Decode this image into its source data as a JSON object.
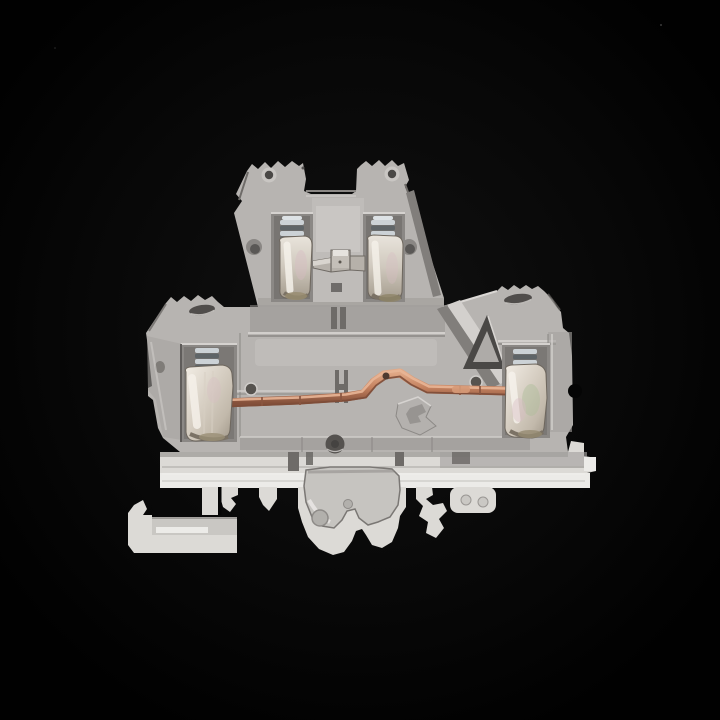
{
  "scene": {
    "type": "product-photograph",
    "description": "Gray double-level DIN rail screw terminal block photographed on a black background, showing two upper and two lower screw clamp terminals, a metal jumper link on the upper level and a bent copper busbar joining the lower terminals, with DIN-rail mounting feet at the bottom",
    "background": "black"
  },
  "colors": {
    "background": "#050505",
    "plastic_light": "#d6d3d0",
    "plastic_mid": "#b7b4b1",
    "plastic_dim": "#a5a29f",
    "plastic_shadow": "#8a8784",
    "plastic_dark": "#6e6b68",
    "cavity_dark": "#5a5755",
    "bottom_white": "#dcdad6",
    "bottom_bright": "#ecebe8",
    "copper_main": "#c98a68",
    "copper_light": "#e3ac8c",
    "copper_dark": "#8a5640",
    "metal_light": "#f0ebe3",
    "metal_mid": "#c9c1b5",
    "metal_shadow": "#968e81",
    "screw_light": "#ccd2d6",
    "screw_dark": "#5f6568",
    "tint_pink": "#d8bcc2",
    "tint_green": "#aebd9a"
  },
  "parts": [
    "upper-level-housing",
    "upper-left-mount-ear",
    "upper-right-mount-ear",
    "upper-left-ear-hole",
    "upper-right-ear-hole",
    "upper-left-terminal",
    "upper-right-terminal",
    "upper-left-clamp-screw",
    "upper-right-clamp-screw",
    "upper-jumper-link-bar",
    "lower-level-housing",
    "lower-left-mount-ear",
    "lower-right-mount-ear",
    "lower-left-ear-slot",
    "lower-right-ear-slot",
    "lower-left-terminal",
    "lower-right-terminal",
    "lower-left-clamp-screw",
    "lower-right-clamp-screw",
    "copper-busbar",
    "triangle-mold-window",
    "center-bracket-mold",
    "rib-hole",
    "bottom-rail",
    "din-hook-left",
    "din-foot-center",
    "din-claw-right",
    "din-tab-right"
  ]
}
